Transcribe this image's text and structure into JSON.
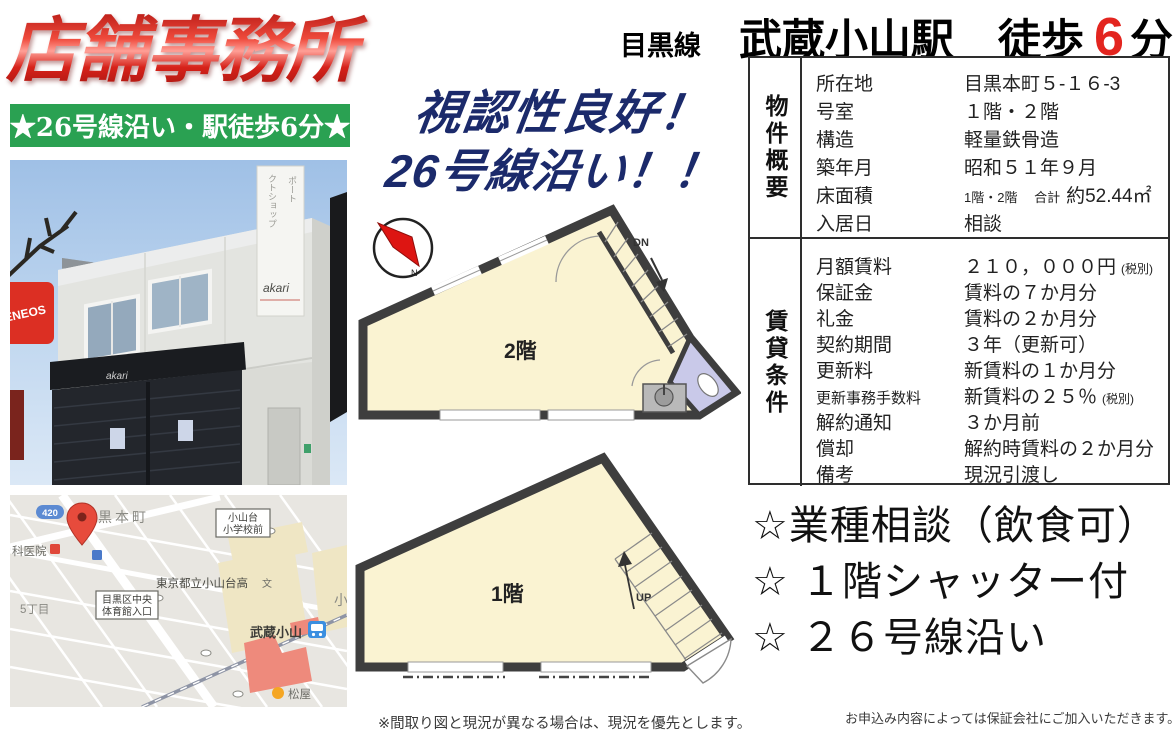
{
  "title": {
    "main": "店舗事務所",
    "banner": "★26号線沿い・駅徒歩6分★"
  },
  "catchcopy": {
    "line1": "視認性良好！",
    "line2": "26号線沿い！！"
  },
  "header": {
    "railline": "目黒線",
    "station": "武蔵小山駅",
    "walk_prefix": "徒歩",
    "walk_minutes": "6",
    "walk_unit": "分"
  },
  "table": {
    "overview": {
      "header": "物件概要",
      "rows": [
        {
          "label": "所在地",
          "value": "目黒本町５-１６-3"
        },
        {
          "label": "号室",
          "value": "１階・２階"
        },
        {
          "label": "構造",
          "value": "軽量鉄骨造"
        },
        {
          "label": "築年月",
          "value": "昭和５１年９月"
        },
        {
          "label": "床面積",
          "value_prefix": "1階・2階　 合計",
          "value": "約52.44㎡"
        },
        {
          "label": "入居日",
          "value": "相談"
        }
      ]
    },
    "conditions": {
      "header": "賃貸条件",
      "rows": [
        {
          "label": "月額賃料",
          "value": "２１０，０００円",
          "note": "(税別)"
        },
        {
          "label": "保証金",
          "value": "賃料の７か月分"
        },
        {
          "label": "礼金",
          "value": "賃料の２か月分"
        },
        {
          "label": "契約期間",
          "value": "３年（更新可）"
        },
        {
          "label": "更新料",
          "value": "新賃料の１か月分"
        },
        {
          "label": "更新事務手数料",
          "value": "新賃料の２５％",
          "note": "(税別)"
        },
        {
          "label": "解約通知",
          "value": "３か月前"
        },
        {
          "label": "償却",
          "value": "解約時賃料の２か月分"
        },
        {
          "label": "備考",
          "value": "現況引渡し"
        }
      ]
    }
  },
  "features": {
    "items": [
      "☆業種相談（飲食可）",
      "☆ １階シャッター付",
      "☆ ２６号線沿い"
    ]
  },
  "notes": {
    "left": "※間取り図と現況が異なる場合は、現況を優先とします。",
    "right": "お申込み内容によっては保証会社にご加入いただきます。"
  },
  "floorplans": {
    "f2_label": "2階",
    "f2_stairs": "DN",
    "f1_label": "1階",
    "f1_stairs": "UP",
    "compass_n": "N"
  },
  "photo": {
    "awning_sign": "akari",
    "board_sign": "akari",
    "board_text1": "ポート",
    "board_text2": "クトショップ",
    "gas_sign": "ENEOS"
  },
  "map": {
    "route_badge": "420",
    "town": "黒本町",
    "hospital": "科医院",
    "busstop1_l1": "小山台",
    "busstop1_l2": "小学校前",
    "school": "東京都立小山台高",
    "school_mark": "文",
    "busstop2_l1": "目黒区中央",
    "busstop2_l2": "体育館入口",
    "district": "5丁目",
    "station": "武蔵小山",
    "matsuya": "松屋",
    "partial": "小"
  },
  "colors": {
    "accent_red": "#e3251f",
    "banner_green": "#2aa152",
    "catch_navy": "#1b2a6b",
    "floor_fill": "#faf3d2",
    "wall": "#3e3e3e",
    "toilet_lavender": "#c9c9e9",
    "map_red_building": "#ee8a7c",
    "pin_red": "#e74b3c"
  }
}
